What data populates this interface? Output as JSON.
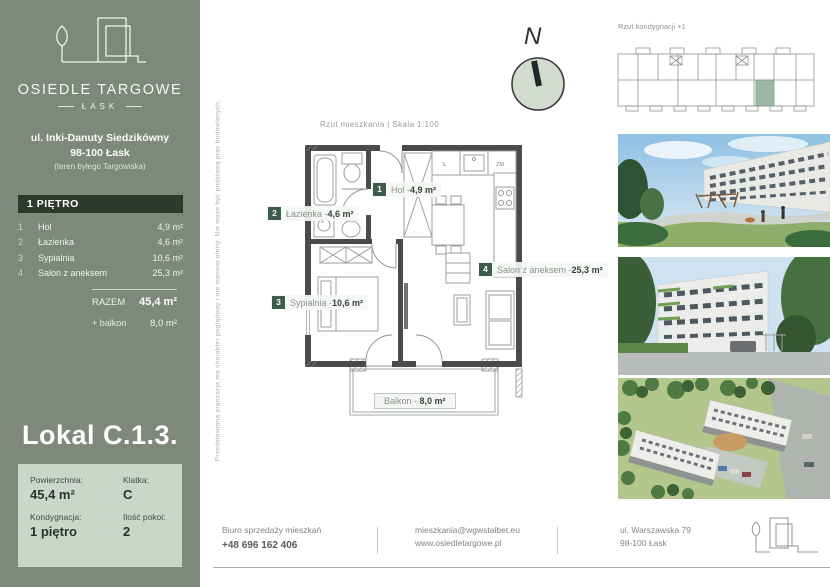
{
  "colors": {
    "sidebar_green": "#7d8a7a",
    "band_dark": "#2d3a30",
    "chip_green": "#3e5c4b",
    "infobox_bg": "#cbd5ca",
    "wall_gray": "#4b4b4b",
    "highlight_unit": "#9cb7a3",
    "line_gray": "#9aa09a"
  },
  "sidebar": {
    "brand_title": "OSIEDLE TARGOWE",
    "brand_sub": "ŁASK",
    "address_line1": "ul. Inki-Danuty Siedzikówny",
    "address_line2": "98-100 Łask",
    "address_line3": "(teren byłego Targowiska)",
    "floor_header": "1 PIĘTRO",
    "rooms": [
      {
        "no": "1",
        "name": "Hol",
        "area": "4,9 m²"
      },
      {
        "no": "2",
        "name": "Łazienka",
        "area": "4,6 m²"
      },
      {
        "no": "3",
        "name": "Sypialnia",
        "area": "10,6 m²"
      },
      {
        "no": "4",
        "name": "Salon z aneksem",
        "area": "25,3 m²"
      }
    ],
    "total_label": "RAZEM",
    "total_value": "45,4 m²",
    "balcony_label": "+ balkon",
    "balcony_value": "8,0 m²",
    "unit_title": "Lokal C.1.3.",
    "info": [
      {
        "label": "Powierzchnia:",
        "value": "45,4 m²"
      },
      {
        "label": "Klatka:",
        "value": "C"
      },
      {
        "label": "Kondygnacja:",
        "value": "1 piętro"
      },
      {
        "label": "Ilość pokoi:",
        "value": "2"
      }
    ]
  },
  "plan": {
    "header": "Rzut mieszkania  |  Skala 1:100",
    "compass": "N",
    "disclaimer": "Przedstawiona aranżacja ma charakter poglądowy i nie stanowi oferty. Nie może być podstawą prac budowlanych.",
    "labels": [
      {
        "no": "1",
        "name": "Hol - ",
        "area": "4,9 m²"
      },
      {
        "no": "2",
        "name": "Łazienka - ",
        "area": "4,6 m²"
      },
      {
        "no": "3",
        "name": "Sypialnia - ",
        "area": "10,6 m²"
      },
      {
        "no": "4",
        "name": "Salon z aneksem - ",
        "area": "25,3 m²"
      }
    ],
    "balcony_label": "Balkon - ",
    "balcony_area": "8,0 m²",
    "appliances": {
      "fridge": "L",
      "dishwasher": "ZM",
      "washer": "P"
    }
  },
  "overview": {
    "title": "Rzut kondygnacji +1"
  },
  "footer": {
    "office_label": "Biuro sprzedaży mieszkań",
    "phone": "+48 696 162 406",
    "email": "mieszkania@wgwstalbet.eu",
    "website": "www.osiedletargowe.pl",
    "address1": "ul. Warszawska 79",
    "address2": "98-100 Łask"
  }
}
